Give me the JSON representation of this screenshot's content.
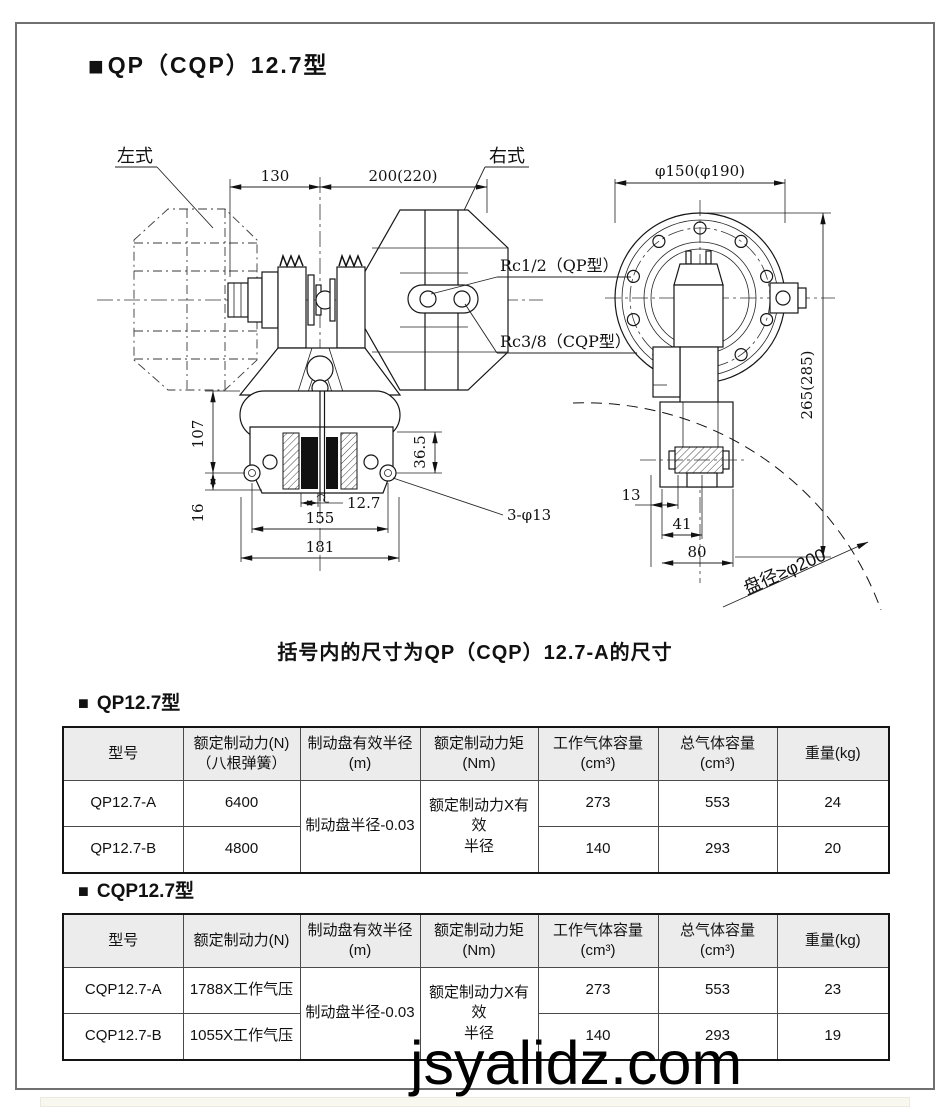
{
  "page": {
    "bullet": "■",
    "title": "QP（CQP）12.7型",
    "caption": "括号内的尺寸为QP（CQP）12.7-A的尺寸",
    "watermark": "jsyalidz.com"
  },
  "drawing": {
    "front": {
      "label_left": "左式",
      "label_right": "右式",
      "dim_130": "130",
      "dim_200": "200(220)",
      "port_qp": "Rc1/2（QP型）",
      "port_cqp": "Rc3/8（CQP型）",
      "dim_107": "107",
      "dim_16": "16",
      "dim_36_5": "36.5",
      "dim_12_7": "12.7",
      "dim_155": "155",
      "dim_181": "181",
      "note_holes": "3-φ13"
    },
    "side": {
      "dim_d150": "φ150(φ190)",
      "dim_265": "265(285)",
      "dim_13": "13",
      "dim_41": "41",
      "dim_80": "80",
      "note_disc": "盘径≥φ200"
    }
  },
  "tables": [
    {
      "title": "QP12.7型",
      "headers": [
        "型号",
        "额定制动力(N)\n（八根弹簧）",
        "制动盘有效半径\n(m)",
        "额定制动力矩\n(Nm)",
        "工作气体容量\n(cm³)",
        "总气体容量\n(cm³)",
        "重量(kg)"
      ],
      "merged_radius": "制动盘半径-0.03",
      "merged_torque": "额定制动力X有效\n半径",
      "rows": [
        {
          "model": "QP12.7-A",
          "force": "6400",
          "work_gas": "273",
          "total_gas": "553",
          "weight": "24"
        },
        {
          "model": "QP12.7-B",
          "force": "4800",
          "work_gas": "140",
          "total_gas": "293",
          "weight": "20"
        }
      ]
    },
    {
      "title": "CQP12.7型",
      "headers": [
        "型号",
        "额定制动力(N)",
        "制动盘有效半径\n(m)",
        "额定制动力矩\n(Nm)",
        "工作气体容量\n(cm³)",
        "总气体容量\n(cm³)",
        "重量(kg)"
      ],
      "merged_radius": "制动盘半径-0.03",
      "merged_torque": "额定制动力X有效\n半径",
      "rows": [
        {
          "model": "CQP12.7-A",
          "force": "1788X工作气压",
          "work_gas": "273",
          "total_gas": "553",
          "weight": "23"
        },
        {
          "model": "CQP12.7-B",
          "force": "1055X工作气压",
          "work_gas": "140",
          "total_gas": "293",
          "weight": "19"
        }
      ]
    }
  ],
  "colors": {
    "line": "#161616",
    "header_bg": "#ececec",
    "frame_border": "#707070"
  }
}
